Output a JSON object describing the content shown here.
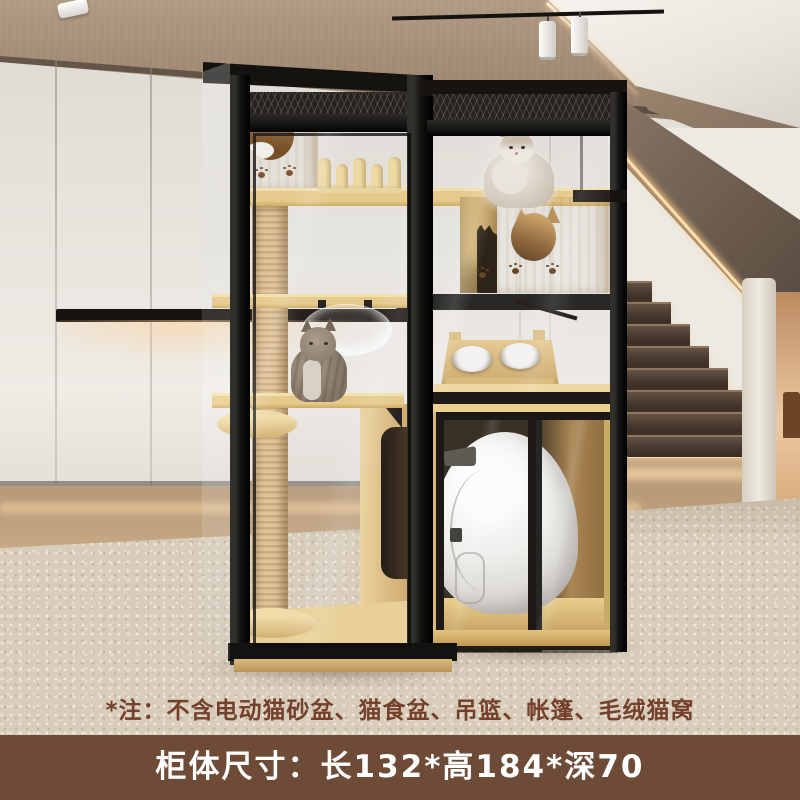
{
  "image_type": "product-photo-cat-villa",
  "note": {
    "text": "*注：不含电动猫砂盆、猫食盆、吊篮、帐篷、毛绒猫窝",
    "color": "#74402c"
  },
  "banner": {
    "text": "柜体尺寸：长132*高184*深70",
    "background": "#6e4b37",
    "text_color": "#ffffff"
  },
  "palette": {
    "frame_black": "#1d1b18",
    "wood_light": "#e7c985",
    "wood_dark": "#c8a255",
    "wall": "#e8e5df",
    "ceiling_wood": "#a28b75",
    "rug": "#d8cdba",
    "floor_wood": "#b89a79",
    "led_glow": "#ffdfae",
    "stair_step": "#46382e",
    "litter_robot": "#f2f0ed"
  }
}
